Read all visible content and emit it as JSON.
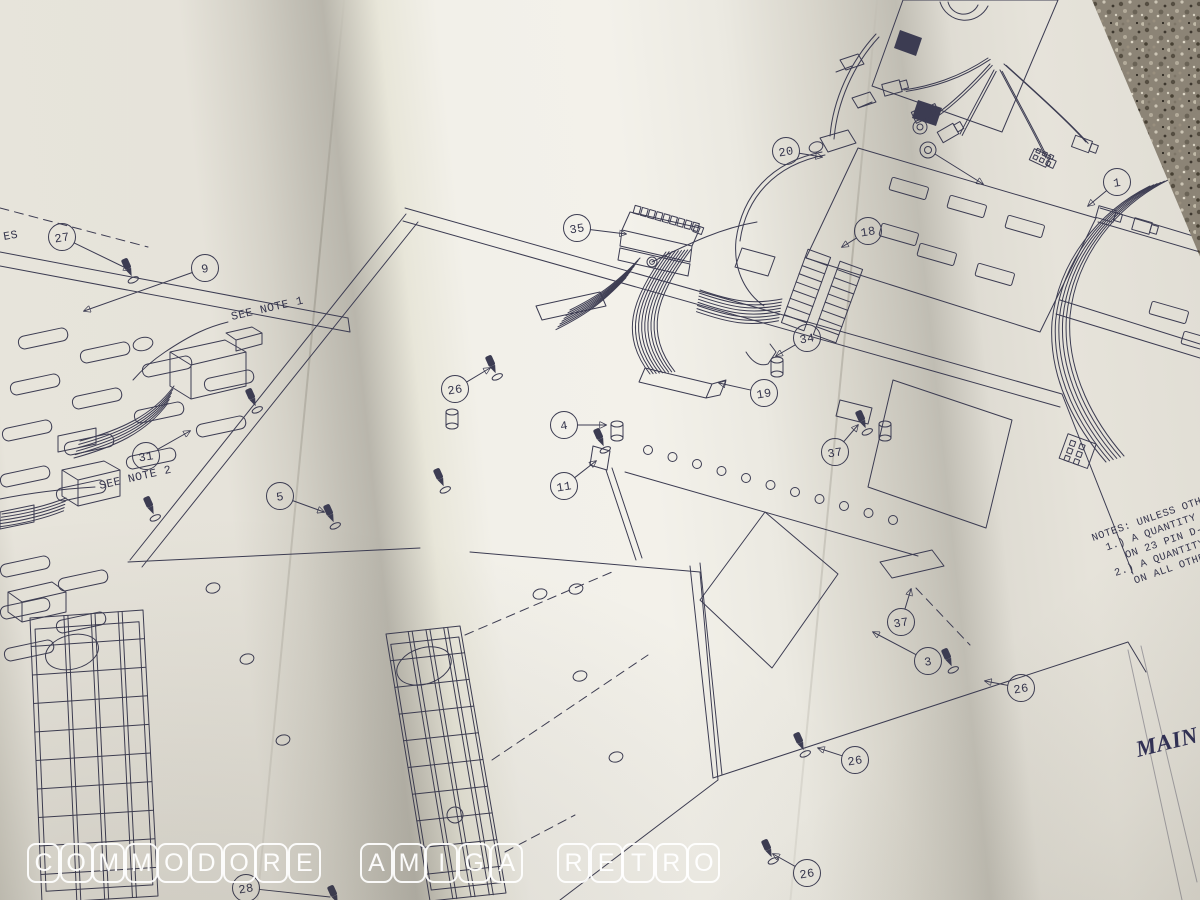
{
  "colors": {
    "ink": "#3c3c52",
    "paper": "#ece9e0",
    "paper_bright": "#f3f1ea",
    "paper_shadow": "#c0bdb3",
    "table_surface": "#8c8476",
    "watermark": "#ffffff",
    "main_title_color": "#2e2e55"
  },
  "labels": {
    "see_note_1": "SEE NOTE 1",
    "see_note_2": "SEE NOTE 2",
    "left_edge_fragment": "ES",
    "main_title": "MAIN"
  },
  "notes": {
    "lines": [
      "NOTES: UNLESS OTHERW",
      "1.) A QUANTITY OF 2",
      "ON 23 PIN D-SUB",
      "2.) A QUANTITY OF",
      "ON ALL OTHER"
    ]
  },
  "callouts": [
    {
      "n": "27",
      "cx": 62,
      "cy": 237,
      "tx": 130,
      "ty": 270
    },
    {
      "n": "9",
      "cx": 205,
      "cy": 268,
      "tx": 84,
      "ty": 311
    },
    {
      "n": "31",
      "cx": 146,
      "cy": 456,
      "tx": 190,
      "ty": 431
    },
    {
      "n": "5",
      "cx": 280,
      "cy": 496,
      "tx": 324,
      "ty": 512
    },
    {
      "n": "26",
      "cx": 455,
      "cy": 389,
      "tx": 490,
      "ty": 368
    },
    {
      "n": "4",
      "cx": 564,
      "cy": 425,
      "tx": 606,
      "ty": 425
    },
    {
      "n": "11",
      "cx": 564,
      "cy": 486,
      "tx": 596,
      "ty": 461
    },
    {
      "n": "35",
      "cx": 577,
      "cy": 228,
      "tx": 626,
      "ty": 234
    },
    {
      "n": "18",
      "cx": 868,
      "cy": 231,
      "tx": 842,
      "ty": 247
    },
    {
      "n": "34",
      "cx": 807,
      "cy": 338,
      "tx": 776,
      "ty": 356
    },
    {
      "n": "19",
      "cx": 764,
      "cy": 393,
      "tx": 719,
      "ty": 383
    },
    {
      "n": "20",
      "cx": 786,
      "cy": 151,
      "tx": 822,
      "ty": 157
    },
    {
      "n": "1",
      "cx": 1117,
      "cy": 182,
      "tx": 1088,
      "ty": 206
    },
    {
      "n": "37",
      "cx": 835,
      "cy": 452,
      "tx": 858,
      "ty": 425
    },
    {
      "n": "37",
      "cx": 901,
      "cy": 622,
      "tx": 911,
      "ty": 589
    },
    {
      "n": "3",
      "cx": 928,
      "cy": 661,
      "tx": 873,
      "ty": 632
    },
    {
      "n": "26",
      "cx": 1021,
      "cy": 688,
      "tx": 985,
      "ty": 681
    },
    {
      "n": "26",
      "cx": 855,
      "cy": 760,
      "tx": 818,
      "ty": 748
    },
    {
      "n": "26",
      "cx": 807,
      "cy": 873,
      "tx": 773,
      "ty": 854
    },
    {
      "n": "28",
      "cx": 246,
      "cy": 888,
      "tx": 330,
      "ty": 897,
      "noarr": true
    }
  ],
  "watermark": {
    "words": [
      {
        "text": "COMMODORE",
        "x": 27
      },
      {
        "text": "AMIGA",
        "x": 360
      },
      {
        "text": "RETRO",
        "x": 557
      }
    ],
    "y": 843,
    "pitch": 32.6
  }
}
